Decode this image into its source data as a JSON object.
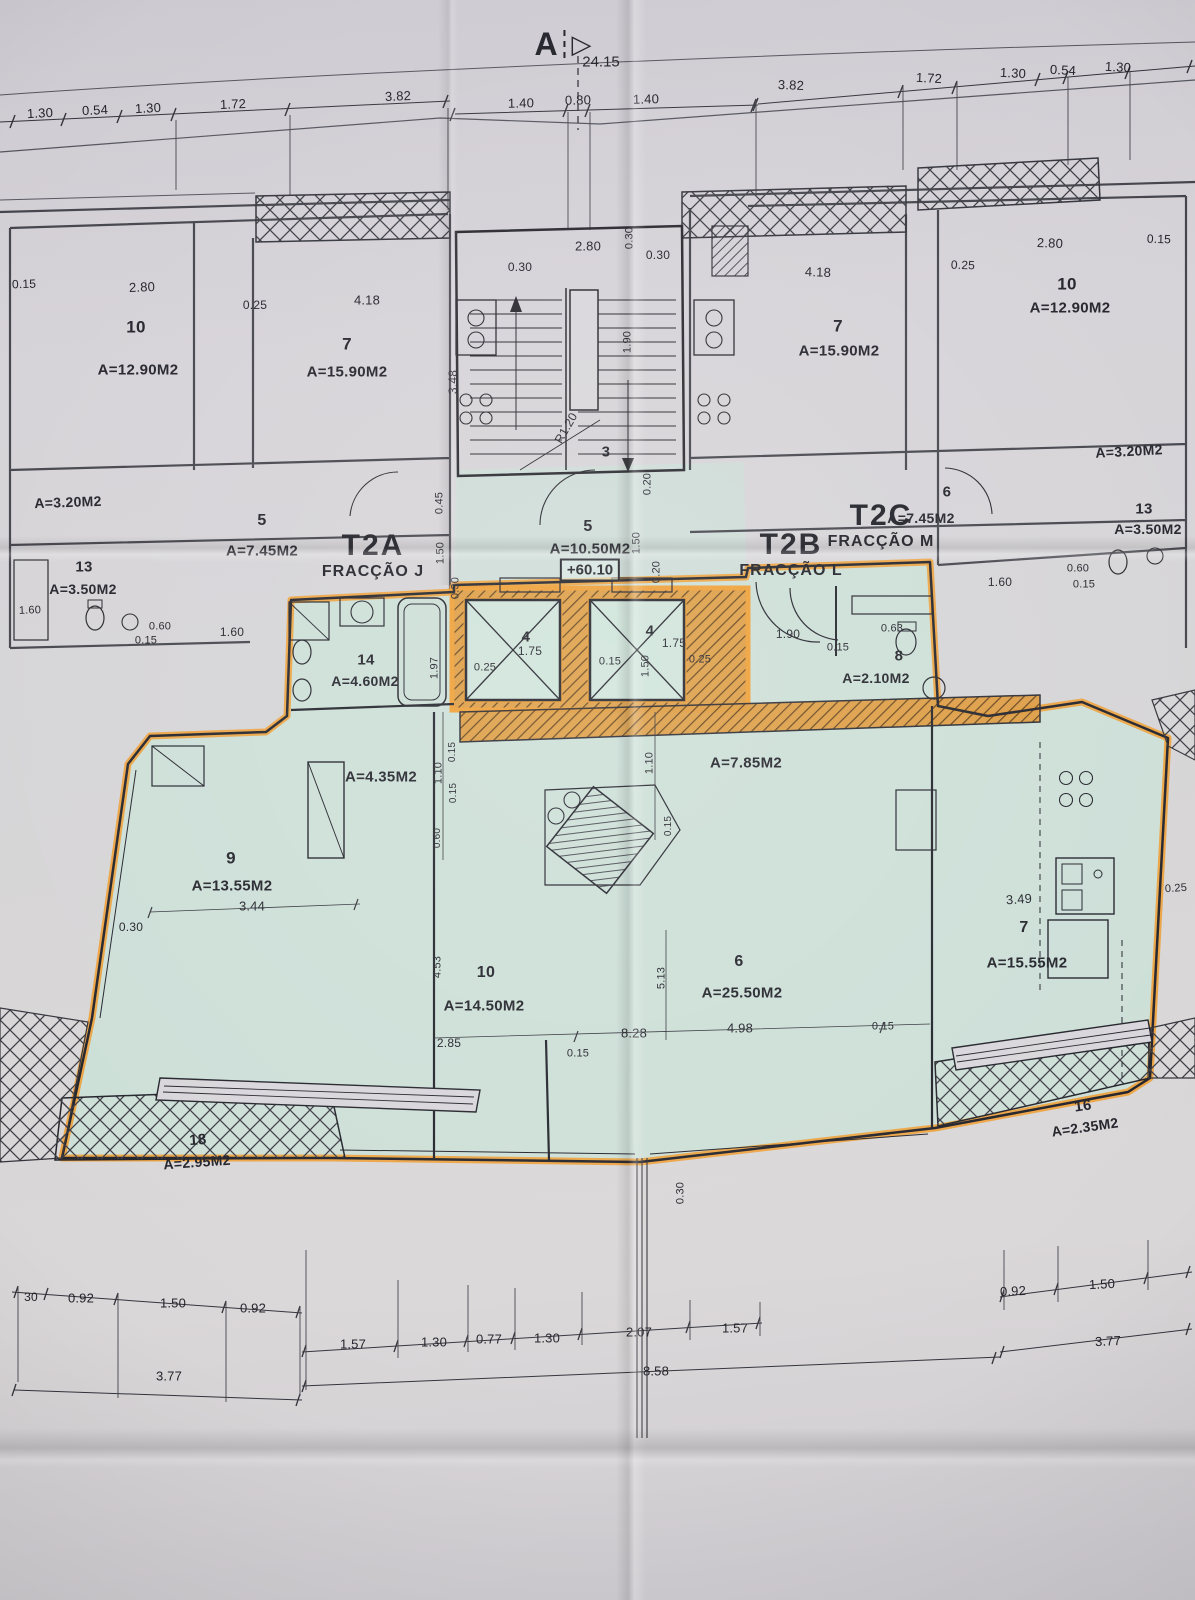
{
  "section_marker": {
    "letter": "A",
    "overall_dimension": "24.15"
  },
  "level_marker": {
    "value": "+60.10"
  },
  "units": [
    {
      "code": "T2A",
      "fraction": "FRACÇÃO J"
    },
    {
      "code": "T2B",
      "fraction": "FRACÇÃO L"
    },
    {
      "code": "T2C",
      "fraction": "FRACÇÃO M"
    }
  ],
  "colors": {
    "highlighter": "#f09b2c",
    "interior_tint": "#c9e1d7",
    "ink": "#22222a"
  },
  "labels": [
    {
      "t": "1.30",
      "x": 40,
      "y": 113,
      "fs": 13,
      "r": -3
    },
    {
      "t": "0.54",
      "x": 95,
      "y": 110,
      "fs": 13,
      "r": -3
    },
    {
      "t": "1.30",
      "x": 148,
      "y": 108,
      "fs": 13,
      "r": -3
    },
    {
      "t": "1.72",
      "x": 233,
      "y": 104,
      "fs": 13,
      "r": -2
    },
    {
      "t": "3.82",
      "x": 398,
      "y": 96,
      "fs": 13,
      "r": -2
    },
    {
      "t": "1.40",
      "x": 521,
      "y": 103,
      "fs": 13,
      "r": -1
    },
    {
      "t": "0.80",
      "x": 578,
      "y": 100,
      "fs": 13,
      "r": -1
    },
    {
      "t": "1.40",
      "x": 646,
      "y": 99,
      "fs": 13,
      "r": -1
    },
    {
      "t": "3.82",
      "x": 791,
      "y": 85,
      "fs": 13,
      "r": 2
    },
    {
      "t": "1.72",
      "x": 929,
      "y": 78,
      "fs": 13,
      "r": 3
    },
    {
      "t": "1.30",
      "x": 1013,
      "y": 73,
      "fs": 13,
      "r": 3
    },
    {
      "t": "0.54",
      "x": 1063,
      "y": 70,
      "fs": 13,
      "r": 3
    },
    {
      "t": "1.30",
      "x": 1118,
      "y": 67,
      "fs": 13,
      "r": 3
    },
    {
      "t": "0.15",
      "x": 24,
      "y": 284,
      "fs": 12,
      "r": -2
    },
    {
      "t": "2.80",
      "x": 142,
      "y": 287,
      "fs": 13,
      "r": -2
    },
    {
      "t": "10",
      "x": 136,
      "y": 327,
      "fs": 17,
      "k": "room-number"
    },
    {
      "t": "A=12.90M2",
      "x": 138,
      "y": 370,
      "fs": 15,
      "k": "room-area"
    },
    {
      "t": "0.25",
      "x": 255,
      "y": 305,
      "fs": 12
    },
    {
      "t": "4.18",
      "x": 367,
      "y": 300,
      "fs": 13
    },
    {
      "t": "7",
      "x": 347,
      "y": 344,
      "fs": 17,
      "k": "room-number"
    },
    {
      "t": "A=15.90M2",
      "x": 347,
      "y": 372,
      "fs": 15,
      "k": "room-area"
    },
    {
      "t": "3.48",
      "x": 453,
      "y": 382,
      "fs": 12,
      "r": -90
    },
    {
      "t": "A=3.20M2",
      "x": 68,
      "y": 502,
      "fs": 14,
      "r": -2,
      "k": "room-area"
    },
    {
      "t": "5",
      "x": 262,
      "y": 521,
      "fs": 16,
      "k": "room-number"
    },
    {
      "t": "A=7.45M2",
      "x": 262,
      "y": 551,
      "fs": 15,
      "k": "room-area"
    },
    {
      "t": "13",
      "x": 84,
      "y": 567,
      "fs": 15,
      "k": "room-number"
    },
    {
      "t": "A=3.50M2",
      "x": 83,
      "y": 589,
      "fs": 14,
      "k": "room-area"
    },
    {
      "t": "1.60",
      "x": 30,
      "y": 611,
      "fs": 11,
      "r": -2
    },
    {
      "t": "0.60",
      "x": 160,
      "y": 627,
      "fs": 11
    },
    {
      "t": "0.15",
      "x": 146,
      "y": 641,
      "fs": 11
    },
    {
      "t": "1.60",
      "x": 232,
      "y": 632,
      "fs": 12
    },
    {
      "t": "2.80",
      "x": 588,
      "y": 246,
      "fs": 13
    },
    {
      "t": "0.30",
      "x": 630,
      "y": 238,
      "fs": 11,
      "r": -90
    },
    {
      "t": "0.30",
      "x": 520,
      "y": 267,
      "fs": 12
    },
    {
      "t": "0.30",
      "x": 658,
      "y": 255,
      "fs": 12
    },
    {
      "t": "1.90",
      "x": 628,
      "y": 342,
      "fs": 11,
      "r": -90
    },
    {
      "t": "R1.20",
      "x": 566,
      "y": 428,
      "fs": 12,
      "r": -60
    },
    {
      "t": "3",
      "x": 606,
      "y": 452,
      "fs": 15,
      "k": "room-number"
    },
    {
      "t": "0.45",
      "x": 440,
      "y": 503,
      "fs": 11,
      "r": -90
    },
    {
      "t": "1.50",
      "x": 441,
      "y": 553,
      "fs": 11,
      "r": -90
    },
    {
      "t": "0.30",
      "x": 456,
      "y": 588,
      "fs": 11,
      "r": -90
    },
    {
      "t": "5",
      "x": 588,
      "y": 527,
      "fs": 16,
      "k": "room-number"
    },
    {
      "t": "A=10.50M2",
      "x": 590,
      "y": 549,
      "fs": 15,
      "k": "room-area"
    },
    {
      "t": "1.50",
      "x": 637,
      "y": 543,
      "fs": 11,
      "r": -90
    },
    {
      "t": "0.20",
      "x": 657,
      "y": 572,
      "fs": 11,
      "r": -90
    },
    {
      "t": "0.20",
      "x": 648,
      "y": 484,
      "fs": 11,
      "r": -90
    },
    {
      "t": "6",
      "x": 947,
      "y": 492,
      "fs": 15,
      "k": "room-number"
    },
    {
      "t": "A=7.45M2",
      "x": 921,
      "y": 518,
      "fs": 14,
      "k": "room-area"
    },
    {
      "t": "4.18",
      "x": 818,
      "y": 272,
      "fs": 13,
      "r": 2
    },
    {
      "t": "7",
      "x": 838,
      "y": 326,
      "fs": 17,
      "k": "room-number"
    },
    {
      "t": "A=15.90M2",
      "x": 839,
      "y": 351,
      "fs": 15,
      "k": "room-area"
    },
    {
      "t": "0.25",
      "x": 963,
      "y": 265,
      "fs": 12,
      "r": 2
    },
    {
      "t": "2.80",
      "x": 1050,
      "y": 243,
      "fs": 13,
      "r": 2
    },
    {
      "t": "0.15",
      "x": 1159,
      "y": 239,
      "fs": 12,
      "r": 2
    },
    {
      "t": "10",
      "x": 1067,
      "y": 284,
      "fs": 17,
      "k": "room-number"
    },
    {
      "t": "A=12.90M2",
      "x": 1070,
      "y": 308,
      "fs": 15,
      "k": "room-area"
    },
    {
      "t": "A=3.20M2",
      "x": 1129,
      "y": 451,
      "fs": 14,
      "r": -3,
      "k": "room-area"
    },
    {
      "t": "13",
      "x": 1144,
      "y": 509,
      "fs": 15,
      "k": "room-number"
    },
    {
      "t": "A=3.50M2",
      "x": 1148,
      "y": 529,
      "fs": 14,
      "k": "room-area"
    },
    {
      "t": "1.60",
      "x": 1000,
      "y": 582,
      "fs": 12
    },
    {
      "t": "0.60",
      "x": 1078,
      "y": 569,
      "fs": 11
    },
    {
      "t": "0.15",
      "x": 1084,
      "y": 585,
      "fs": 11
    },
    {
      "t": "1.90",
      "x": 788,
      "y": 634,
      "fs": 12
    },
    {
      "t": "0.15",
      "x": 838,
      "y": 648,
      "fs": 11
    },
    {
      "t": "0.63",
      "x": 892,
      "y": 629,
      "fs": 11
    },
    {
      "t": "8",
      "x": 899,
      "y": 656,
      "fs": 15,
      "k": "room-number"
    },
    {
      "t": "A=2.10M2",
      "x": 876,
      "y": 678,
      "fs": 14,
      "k": "room-area"
    },
    {
      "t": "14",
      "x": 366,
      "y": 660,
      "fs": 15,
      "k": "room-number"
    },
    {
      "t": "A=4.60M2",
      "x": 365,
      "y": 681,
      "fs": 14,
      "k": "room-area"
    },
    {
      "t": "1.97",
      "x": 435,
      "y": 668,
      "fs": 11,
      "r": -90
    },
    {
      "t": "4",
      "x": 526,
      "y": 637,
      "fs": 15,
      "k": "room-number"
    },
    {
      "t": "1.75",
      "x": 530,
      "y": 651,
      "fs": 12
    },
    {
      "t": "0.25",
      "x": 485,
      "y": 668,
      "fs": 11
    },
    {
      "t": "0.15",
      "x": 610,
      "y": 662,
      "fs": 11
    },
    {
      "t": "4",
      "x": 650,
      "y": 631,
      "fs": 15,
      "k": "room-number"
    },
    {
      "t": "1.75",
      "x": 674,
      "y": 643,
      "fs": 12
    },
    {
      "t": "1.50",
      "x": 646,
      "y": 666,
      "fs": 11,
      "r": -90
    },
    {
      "t": "0.25",
      "x": 700,
      "y": 660,
      "fs": 11
    },
    {
      "t": "A=4.35M2",
      "x": 381,
      "y": 777,
      "fs": 15,
      "k": "room-area"
    },
    {
      "t": "1.10",
      "x": 439,
      "y": 773,
      "fs": 11,
      "r": -90
    },
    {
      "t": "0.15",
      "x": 453,
      "y": 752,
      "fs": 10,
      "r": -90
    },
    {
      "t": "0.15",
      "x": 454,
      "y": 793,
      "fs": 10,
      "r": -90
    },
    {
      "t": "0.60",
      "x": 438,
      "y": 838,
      "fs": 10,
      "r": -90
    },
    {
      "t": "A=7.85M2",
      "x": 746,
      "y": 763,
      "fs": 15,
      "k": "room-area"
    },
    {
      "t": "1.10",
      "x": 650,
      "y": 763,
      "fs": 11,
      "r": -90
    },
    {
      "t": "0.15",
      "x": 669,
      "y": 826,
      "fs": 10,
      "r": -90
    },
    {
      "t": "9",
      "x": 231,
      "y": 858,
      "fs": 17,
      "k": "room-number"
    },
    {
      "t": "A=13.55M2",
      "x": 232,
      "y": 886,
      "fs": 15,
      "k": "room-area"
    },
    {
      "t": "3.44",
      "x": 252,
      "y": 906,
      "fs": 13
    },
    {
      "t": "0.30",
      "x": 131,
      "y": 927,
      "fs": 12
    },
    {
      "t": "4.53",
      "x": 438,
      "y": 967,
      "fs": 11,
      "r": -90
    },
    {
      "t": "10",
      "x": 486,
      "y": 973,
      "fs": 16,
      "k": "room-number"
    },
    {
      "t": "A=14.50M2",
      "x": 484,
      "y": 1006,
      "fs": 15,
      "k": "room-area"
    },
    {
      "t": "2.85",
      "x": 449,
      "y": 1043,
      "fs": 12
    },
    {
      "t": "0.15",
      "x": 578,
      "y": 1054,
      "fs": 11
    },
    {
      "t": "5.13",
      "x": 662,
      "y": 978,
      "fs": 11,
      "r": -90
    },
    {
      "t": "8.28",
      "x": 634,
      "y": 1033,
      "fs": 13
    },
    {
      "t": "6",
      "x": 739,
      "y": 962,
      "fs": 16,
      "k": "room-number"
    },
    {
      "t": "A=25.50M2",
      "x": 742,
      "y": 993,
      "fs": 15,
      "k": "room-area"
    },
    {
      "t": "4.98",
      "x": 740,
      "y": 1028,
      "fs": 13
    },
    {
      "t": "0.15",
      "x": 883,
      "y": 1027,
      "fs": 11
    },
    {
      "t": "3.49",
      "x": 1019,
      "y": 899,
      "fs": 13,
      "r": -4
    },
    {
      "t": "7",
      "x": 1024,
      "y": 928,
      "fs": 16,
      "k": "room-number"
    },
    {
      "t": "A=15.55M2",
      "x": 1027,
      "y": 963,
      "fs": 15,
      "k": "room-area"
    },
    {
      "t": "0.25",
      "x": 1176,
      "y": 889,
      "fs": 11,
      "r": -4
    },
    {
      "t": "18",
      "x": 198,
      "y": 1140,
      "fs": 15,
      "r": -4,
      "k": "room-number"
    },
    {
      "t": "A=2.95M2",
      "x": 197,
      "y": 1162,
      "fs": 14,
      "r": -4,
      "k": "room-area"
    },
    {
      "t": "16",
      "x": 1083,
      "y": 1106,
      "fs": 15,
      "r": -8,
      "k": "room-number"
    },
    {
      "t": "A=2.35M2",
      "x": 1085,
      "y": 1127,
      "fs": 14,
      "r": -8,
      "k": "room-area"
    },
    {
      "t": "0.30",
      "x": 681,
      "y": 1193,
      "fs": 11,
      "r": -90
    },
    {
      "t": "30",
      "x": 31,
      "y": 1297,
      "fs": 12
    },
    {
      "t": "0.92",
      "x": 81,
      "y": 1298,
      "fs": 13
    },
    {
      "t": "1.50",
      "x": 173,
      "y": 1303,
      "fs": 13
    },
    {
      "t": "0.92",
      "x": 253,
      "y": 1308,
      "fs": 13
    },
    {
      "t": "1.57",
      "x": 353,
      "y": 1344,
      "fs": 13
    },
    {
      "t": "1.30",
      "x": 434,
      "y": 1342,
      "fs": 13
    },
    {
      "t": "0.77",
      "x": 489,
      "y": 1339,
      "fs": 13
    },
    {
      "t": "1.30",
      "x": 547,
      "y": 1338,
      "fs": 13
    },
    {
      "t": "2.07",
      "x": 639,
      "y": 1332,
      "fs": 13
    },
    {
      "t": "1.57",
      "x": 735,
      "y": 1328,
      "fs": 13
    },
    {
      "t": "0.92",
      "x": 1013,
      "y": 1291,
      "fs": 13,
      "r": -3
    },
    {
      "t": "1.50",
      "x": 1102,
      "y": 1284,
      "fs": 13,
      "r": -3
    },
    {
      "t": "3.77",
      "x": 169,
      "y": 1376,
      "fs": 13
    },
    {
      "t": "8.58",
      "x": 656,
      "y": 1371,
      "fs": 13
    },
    {
      "t": "3.77",
      "x": 1108,
      "y": 1341,
      "fs": 13,
      "r": -3
    }
  ]
}
